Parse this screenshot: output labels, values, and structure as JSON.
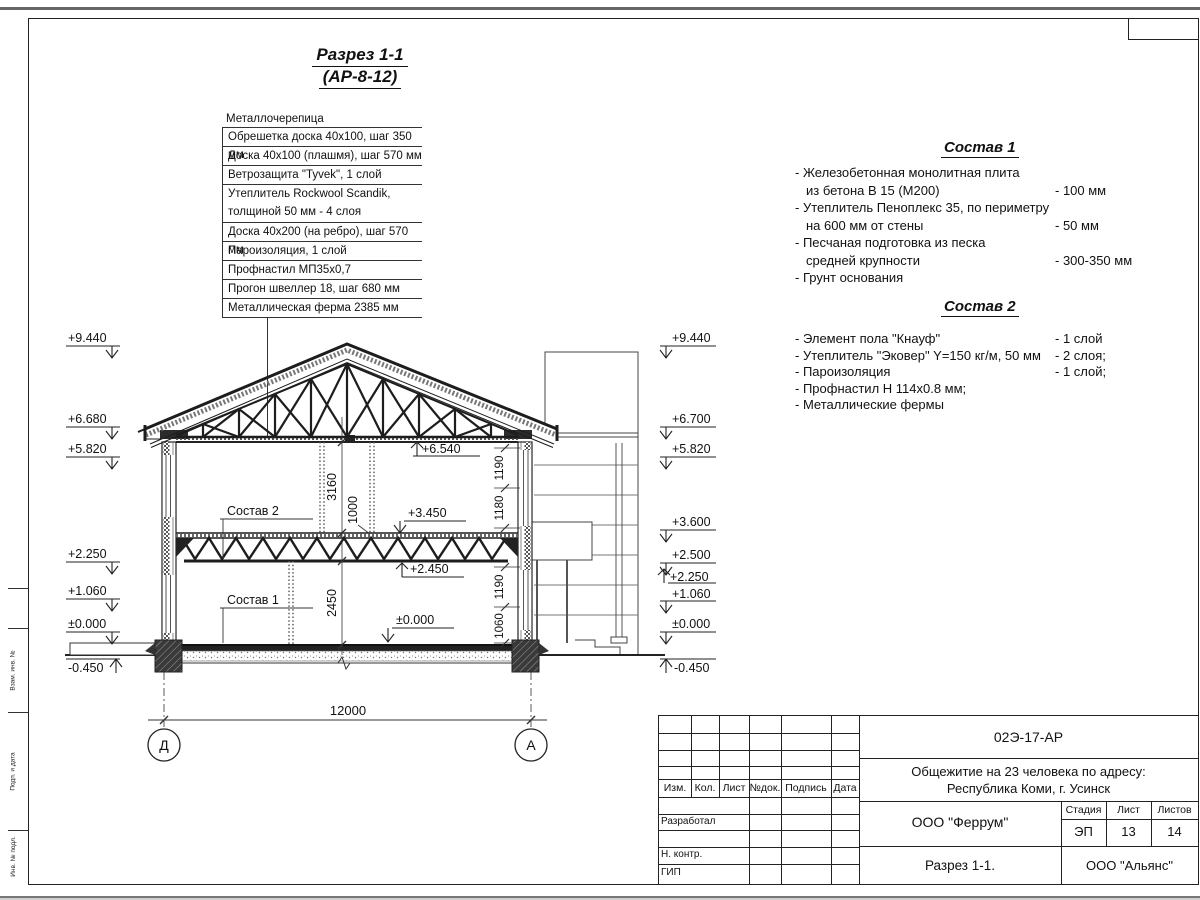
{
  "drawing_title": {
    "line1": "Разрез 1-1",
    "line2": "(АР-8-12)"
  },
  "roof_callout": {
    "header": "Металлочерепица",
    "items": [
      [
        "Обрешетка доска 40х100, шаг 350 мм"
      ],
      [
        "Доска 40х100 (плашмя), шаг 570 мм"
      ],
      [
        "Ветрозащита \"Tyvek\", 1 слой"
      ],
      [
        "Утеплитель Rockwool Scandik,",
        "толщиной 50 мм - 4 слоя"
      ],
      [
        "Доска 40х200 (на ребро), шаг 570 мм"
      ],
      [
        "Пароизоляция, 1 слой"
      ],
      [
        "Профнастил МП35х0,7"
      ],
      [
        "Прогон швеллер 18, шаг 680 мм"
      ],
      [
        "Металлическая ферма 2385 мм"
      ]
    ]
  },
  "sostav1": {
    "title": "Состав 1",
    "items": [
      {
        "line1": "- Железобетонная  монолитная плита",
        "line2": "из бетона В 15 (М200)",
        "value": "- 100 мм"
      },
      {
        "line1": "- Утеплитель Пеноплекс 35, по периметру",
        "line2": "на 600 мм от стены",
        "value": "- 50 мм"
      },
      {
        "line1": "- Песчаная подготовка из песка",
        "line2": "средней крупности",
        "value": "- 300-350 мм"
      },
      {
        "line1": "- Грунт основания",
        "line2": "",
        "value": ""
      }
    ]
  },
  "sostav2": {
    "title": "Состав 2",
    "items": [
      {
        "text": "- Элемент пола \"Кнауф\"",
        "value": "- 1 слой"
      },
      {
        "text": "- Утеплитель \"Эковер\" Y=150 кг/м, 50 мм",
        "value": "- 2 слоя;"
      },
      {
        "text": "- Пароизоляция",
        "value": "- 1 слой;"
      },
      {
        "text": "- Профнастил Н 114х0.8 мм;",
        "value": ""
      },
      {
        "text": "- Металлические фермы",
        "value": ""
      }
    ]
  },
  "section": {
    "left_marks": [
      "+9.440",
      "+6.680",
      "+5.820",
      "+2.250",
      "+1.060",
      "±0.000",
      "-0.450"
    ],
    "right_marks": [
      "+9.440",
      "+6.700",
      "+5.820",
      "+3.600",
      "+2.500",
      "+2.250",
      "+1.060",
      "±0.000",
      "-0.450"
    ],
    "inner_marks": {
      "attic": "+6.540",
      "floor2": "+3.450",
      "truss": "+2.450",
      "floor1": "±0.000"
    },
    "dims": {
      "v1": "3160",
      "v2": "1000",
      "v3": "2450",
      "r1": "1190",
      "r2": "1180",
      "r3": "1190",
      "r4": "1060",
      "total": "12000"
    },
    "labels": {
      "sostav2": "Состав 2",
      "sostav1": "Состав 1"
    },
    "axes": {
      "left": "Д",
      "right": "А"
    }
  },
  "stamp": {
    "code": "02Э-17-АР",
    "project_line1": "Общежитие на 23 человека по адресу:",
    "project_line2": "Республика Коми, г. Усинск",
    "designer_org": "ООО \"Феррум\"",
    "stage_label": "Стадия",
    "sheet_label": "Лист",
    "sheets_label": "Листов",
    "stage": "ЭП",
    "sheet_no": "13",
    "sheets_total": "14",
    "drawing_name": "Разрез 1-1.",
    "customer_org": "ООО \"Альянс\"",
    "header_cols": [
      "Изм.",
      "Кол.",
      "Лист",
      "№док.",
      "Подпись",
      "Дата"
    ],
    "roles": [
      "Разработал",
      "Н. контр.",
      "ГИП"
    ]
  },
  "margin_labels": [
    "Взам. инв. №",
    "Подп. и дата",
    "Инв. № подл."
  ]
}
